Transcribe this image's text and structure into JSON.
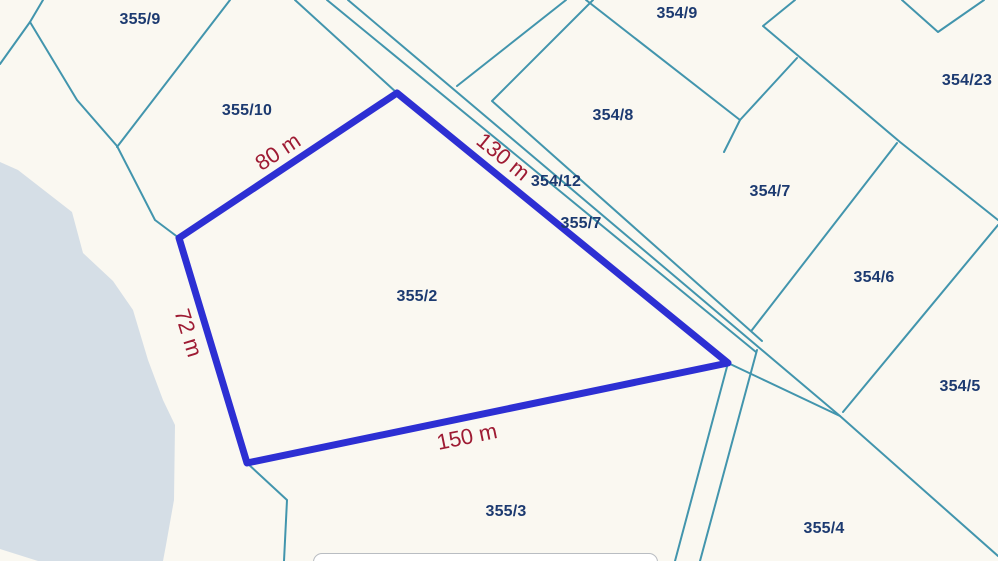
{
  "map": {
    "type": "cadastral-parcel-map",
    "colors": {
      "background": "#faf8f1",
      "water": "#d5dee6",
      "parcel_line": "#4295ad",
      "highlight_stroke": "#2d2fd3",
      "measurement_text": "#9e1b33",
      "parcel_label_text": "#1c3a70"
    },
    "parcel_labels": [
      {
        "id": "355/9",
        "x": 140,
        "y": 20
      },
      {
        "id": "355/10",
        "x": 247,
        "y": 111
      },
      {
        "id": "354/9",
        "x": 677,
        "y": 14
      },
      {
        "id": "354/8",
        "x": 613,
        "y": 116
      },
      {
        "id": "354/12",
        "x": 556,
        "y": 182
      },
      {
        "id": "355/7",
        "x": 581,
        "y": 224
      },
      {
        "id": "354/7",
        "x": 770,
        "y": 192
      },
      {
        "id": "354/23",
        "x": 967,
        "y": 81
      },
      {
        "id": "354/6",
        "x": 874,
        "y": 278
      },
      {
        "id": "354/5",
        "x": 960,
        "y": 387
      },
      {
        "id": "355/2",
        "x": 417,
        "y": 297
      },
      {
        "id": "355/3",
        "x": 506,
        "y": 512
      },
      {
        "id": "355/4",
        "x": 824,
        "y": 529
      }
    ],
    "highlighted_parcel": {
      "id": "355/2",
      "vertices": [
        [
          397,
          93
        ],
        [
          728,
          363
        ],
        [
          247,
          463
        ],
        [
          179,
          238
        ]
      ],
      "side_measurements": [
        {
          "text": "80 m",
          "x": 278,
          "y": 152,
          "rot": -33.5
        },
        {
          "text": "130 m",
          "x": 503,
          "y": 157,
          "rot": 39.3
        },
        {
          "text": "72 m",
          "x": 188,
          "y": 333,
          "rot": 73
        },
        {
          "text": "150 m",
          "x": 467,
          "y": 437,
          "rot": -11.6
        }
      ]
    }
  }
}
